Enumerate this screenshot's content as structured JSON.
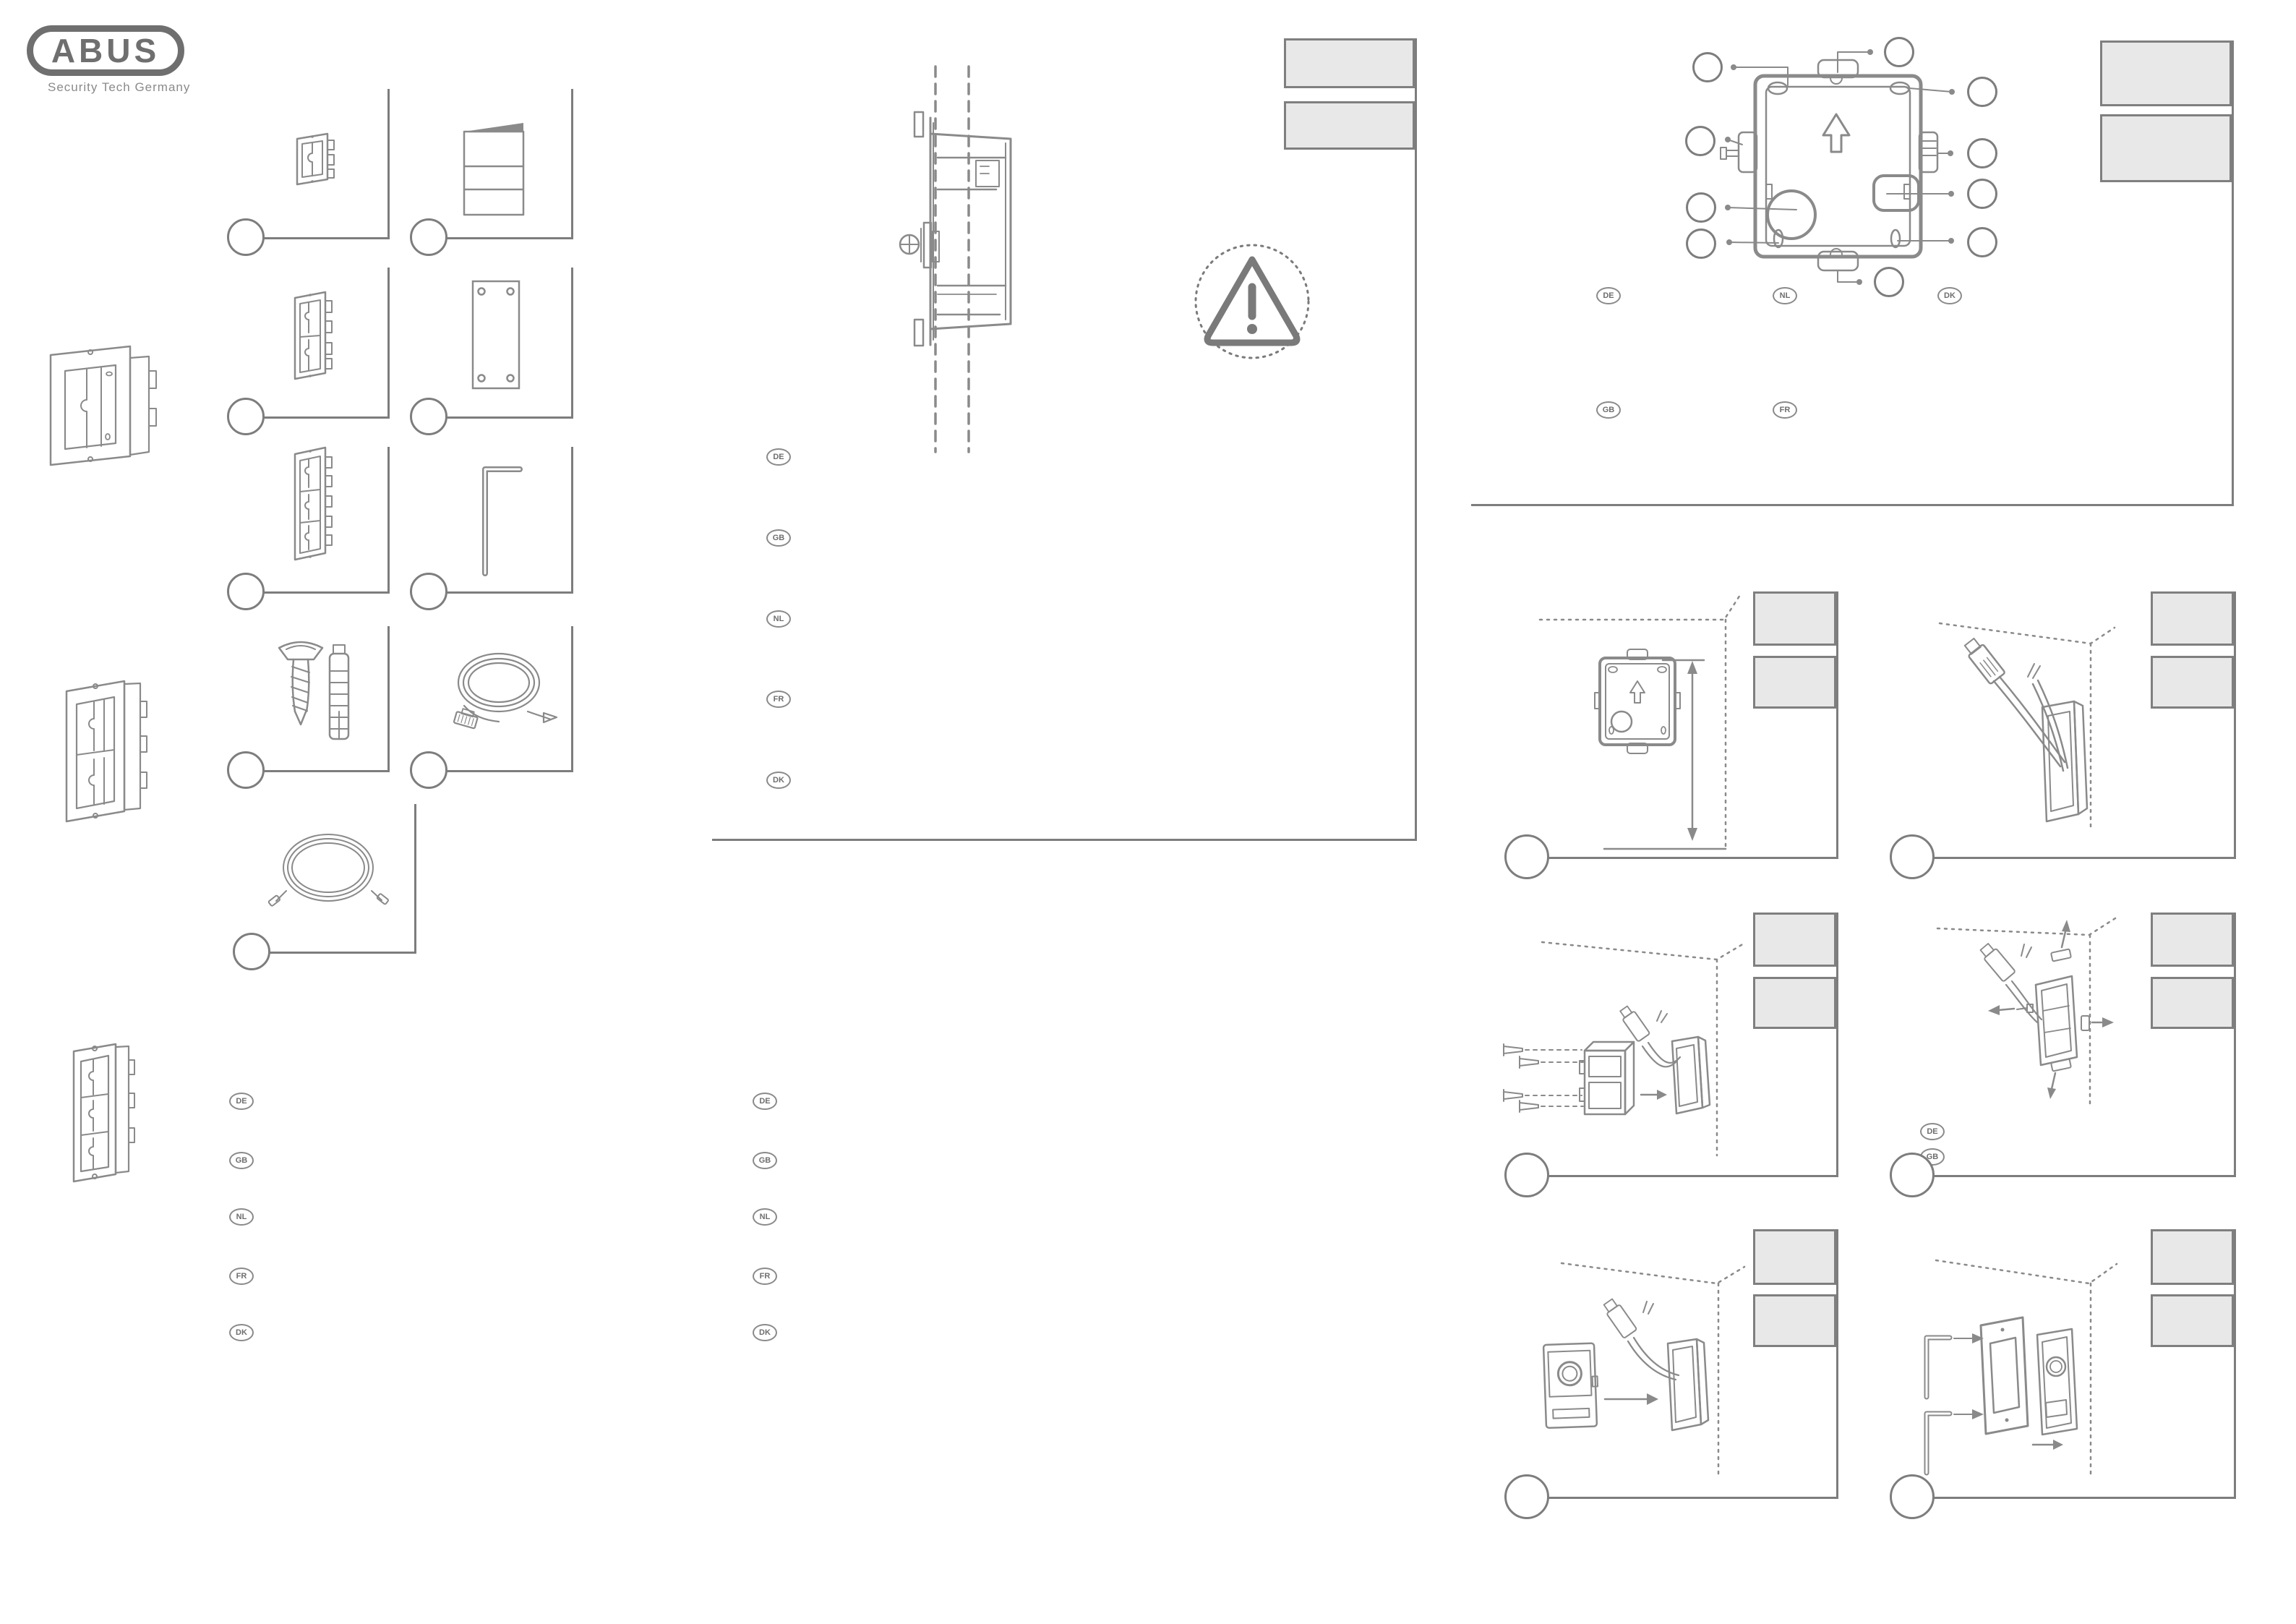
{
  "page": {
    "type": "installation-manual-sheet",
    "document": "flush-mount intercom installation guide"
  },
  "brand": {
    "logo_text": "ABUS",
    "tagline": "Security Tech Germany"
  },
  "colors": {
    "line": "#8a8a8a",
    "dark_line": "#6f6f6f",
    "placeholder_fill": "#e8e8e8",
    "placeholder_border": "#7f7f7f"
  },
  "language_badges": {
    "center_column": [
      "DE",
      "GB",
      "NL",
      "FR",
      "DK"
    ],
    "bottom_column_1": [
      "DE",
      "GB",
      "NL",
      "FR",
      "DK"
    ],
    "bottom_column_2": [
      "DE",
      "GB",
      "NL",
      "FR",
      "DK"
    ],
    "top_right_row_1": [
      "DE",
      "NL",
      "DK"
    ],
    "top_right_row_2": [
      "GB",
      "FR"
    ],
    "step4_badges": [
      "DE",
      "GB"
    ]
  },
  "parts_list": {
    "callout_circles": 9,
    "items": [
      {
        "icon": "flush-mount-box-1-module-icon"
      },
      {
        "icon": "instruction-booklet-icon"
      },
      {
        "icon": "flush-mount-box-2-module-icon"
      },
      {
        "icon": "mounting-plate-icon"
      },
      {
        "icon": "flush-mount-box-3-module-icon"
      },
      {
        "icon": "allen-key-icon"
      },
      {
        "icon": "screw-and-wall-plug-icon"
      },
      {
        "icon": "network-cable-icon"
      },
      {
        "icon": "connection-cable-icon"
      }
    ]
  },
  "diagrams": {
    "cross_section_callouts": 0,
    "back_box_overview_callouts": 10,
    "installation_steps": 6,
    "step_title_placeholders_per_step": 2
  }
}
